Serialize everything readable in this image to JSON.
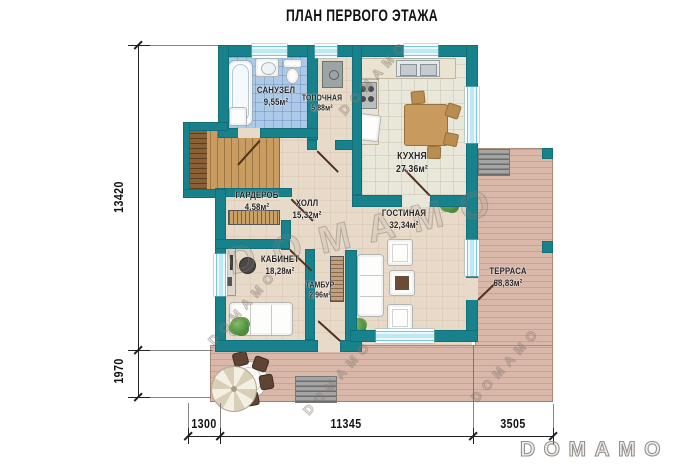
{
  "title": "ПЛАН ПЕРВОГО ЭТАЖА",
  "watermark": "DOMAMO",
  "logo": "DOMAMO",
  "rooms": {
    "bathroom": {
      "name": "САНУЗЕЛ",
      "area": "9,55м²"
    },
    "boiler": {
      "name": "ТОПОЧНАЯ",
      "area": "5,88м²"
    },
    "kitchen": {
      "name": "КУХНЯ",
      "area": "27,36м²"
    },
    "wardrobe": {
      "name": "ГАРДЕРОБ",
      "area": "4,58м²"
    },
    "hall": {
      "name": "ХОЛЛ",
      "area": "15,32м²"
    },
    "office": {
      "name": "КАБИНЕТ",
      "area": "18,28м²"
    },
    "tambour": {
      "name": "ТАМБУР",
      "area": "2,96м²"
    },
    "living": {
      "name": "ГОСТИНАЯ",
      "area": "32,34м²"
    },
    "terrace": {
      "name": "ТЕРРАСА",
      "area": "68,83м²"
    }
  },
  "dimensions": {
    "left_total": "13420",
    "left_lower": "1970",
    "bottom_left": "1300",
    "bottom_middle": "11345",
    "bottom_right": "3505"
  },
  "colors": {
    "wall": "#17818c",
    "window_glass": "#bfe9f2",
    "deck": "#d9b8aa",
    "bath_tile": "#acc9e8",
    "floor": "#e8dac9",
    "kitchen_tile": "#e9e7da"
  }
}
